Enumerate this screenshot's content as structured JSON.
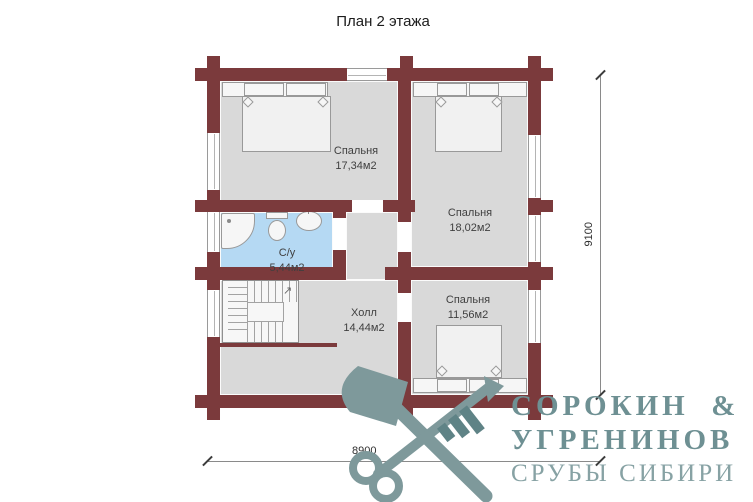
{
  "title": "План 2 этажа",
  "rooms": [
    {
      "name": "Спальня",
      "area": "17,34м2"
    },
    {
      "name": "Спальня",
      "area": "18,02м2"
    },
    {
      "name": "С/у",
      "area": "5,44м2"
    },
    {
      "name": "Холл",
      "area": "14,44м2"
    },
    {
      "name": "Спальня",
      "area": "11,56м2"
    }
  ],
  "dimensions": {
    "horizontal": "8900",
    "vertical": "9100"
  },
  "logo": {
    "line1": "СОРОКИН  &",
    "line2": "УГРЕНИНОВ",
    "line3": "СРУБЫ СИБИРИ"
  },
  "icons": {
    "emblem": "crossed-axe-and-key",
    "stairs_arrow": "↗"
  },
  "colors": {
    "wall": "#7b3a3c",
    "room_fill": "#d9d9d9",
    "bathroom_fill": "#b5d9f3",
    "logo": "#7e999b",
    "logo_subtitle": "#87a2a4"
  }
}
